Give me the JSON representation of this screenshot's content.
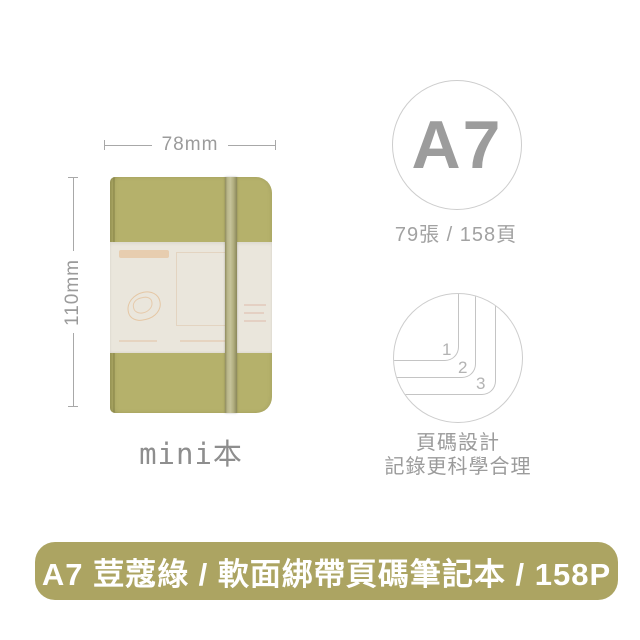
{
  "dimensions": {
    "width": "78mm",
    "height": "110mm"
  },
  "notebook": {
    "caption": "mini本"
  },
  "spec_badge": {
    "size": "A7",
    "sheets_pages": "79張 / 158頁"
  },
  "page_number_feature": {
    "numbers": [
      "1",
      "2",
      "3"
    ],
    "caption_line1": "頁碼設計",
    "caption_line2": "記錄更科學合理"
  },
  "banner": {
    "title": "A7 荳蔻綠 / 軟面綁帶頁碼筆記本 / 158P"
  },
  "colors": {
    "cover": "#b5b16b",
    "belly_band": "#eae6dc",
    "banner_bg": "#aca462",
    "line_gray": "#a8a8a8",
    "line_soft": "#c4c4c4",
    "text_gray": "#9b9b9b",
    "circle_border": "#cdcdcd"
  }
}
